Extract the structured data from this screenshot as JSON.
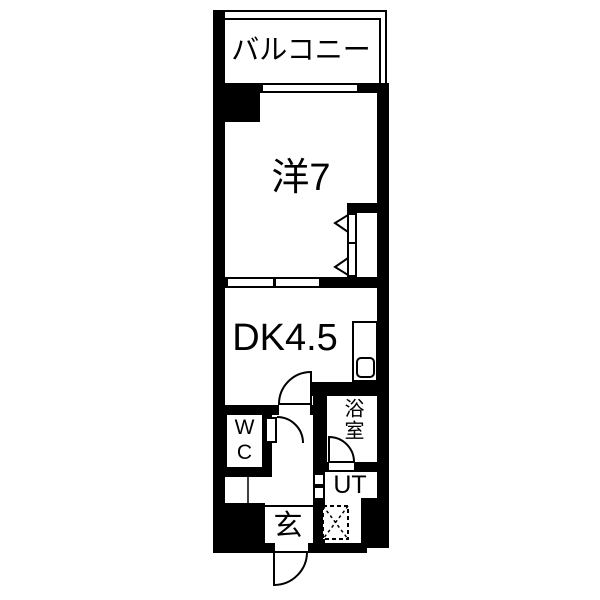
{
  "plan": {
    "type": "apartment-floorplan",
    "colors": {
      "wall": "#000000",
      "floor": "#ffffff"
    },
    "labels": {
      "balcony": "バルコニー",
      "western_room": "洋7",
      "dining_kitchen": "DK4.5",
      "wc": "WC",
      "bathroom": "浴室",
      "utility": "UT",
      "entrance": "玄"
    }
  }
}
